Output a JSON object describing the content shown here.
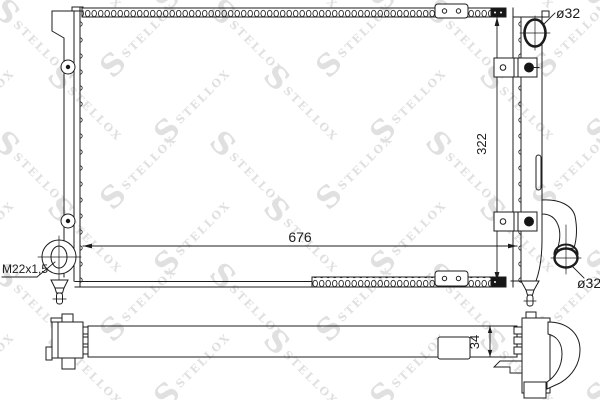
{
  "drawing": {
    "labels": {
      "dim_width": "676",
      "dim_height": "322",
      "dim_depth": "34",
      "thread": "M22x1,5",
      "inlet_diameter": "ø32",
      "outlet_diameter": "ø32"
    }
  },
  "watermark": {
    "text": "STELLOX",
    "logo": "S"
  },
  "colors": {
    "line": "#1c1c1c",
    "watermark": "#e0e0e0",
    "background": "#ffffff"
  }
}
